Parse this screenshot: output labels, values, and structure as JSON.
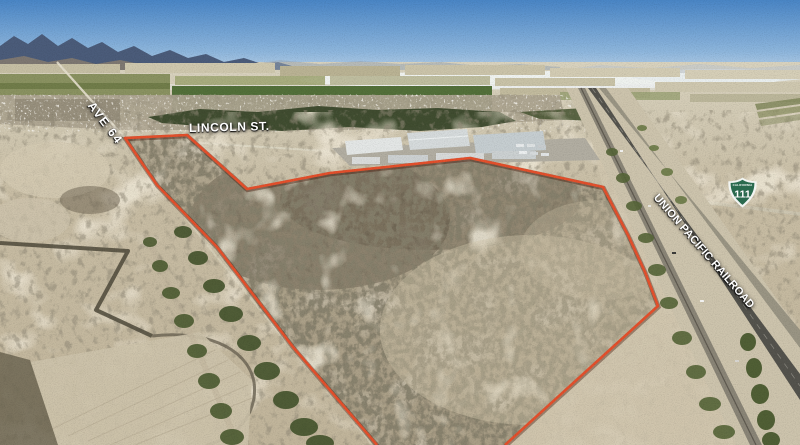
{
  "labels": {
    "ave_64": "AVE 64",
    "lincoln_st": "LINCOLN ST.",
    "railroad": "UNION PACIFIC RAILROAD"
  },
  "route_shield": {
    "state": "CALIFORNIA",
    "number": "111",
    "sign_color": "#2a6a4e"
  },
  "boundary": {
    "color": "#e4502c"
  },
  "label_text_color": "#ffffff"
}
